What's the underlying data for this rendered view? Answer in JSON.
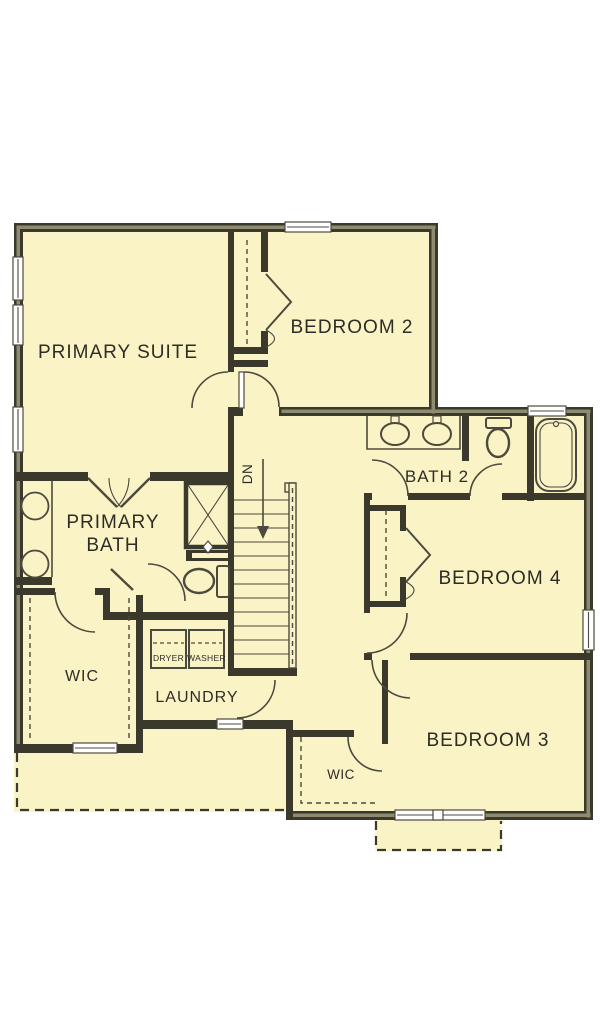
{
  "plan": {
    "rooms": {
      "primary_suite": "PRIMARY SUITE",
      "bedroom2": "BEDROOM 2",
      "bath2": "BATH 2",
      "primary_bath_line1": "PRIMARY",
      "primary_bath_line2": "BATH",
      "bedroom4": "BEDROOM 4",
      "bedroom3": "BEDROOM 3",
      "wic_primary": "WIC",
      "wic_bedroom3": "WIC",
      "laundry": "LAUNDRY"
    },
    "appliances": {
      "dryer": "DRYER",
      "washer": "WASHER"
    },
    "stairs": {
      "direction_label": "DN"
    },
    "colors": {
      "floor": "#faf3c6",
      "wall": "#3b392b",
      "core": "#8e8b70",
      "line": "#4c4a3e",
      "text": "#2e2c26"
    }
  }
}
